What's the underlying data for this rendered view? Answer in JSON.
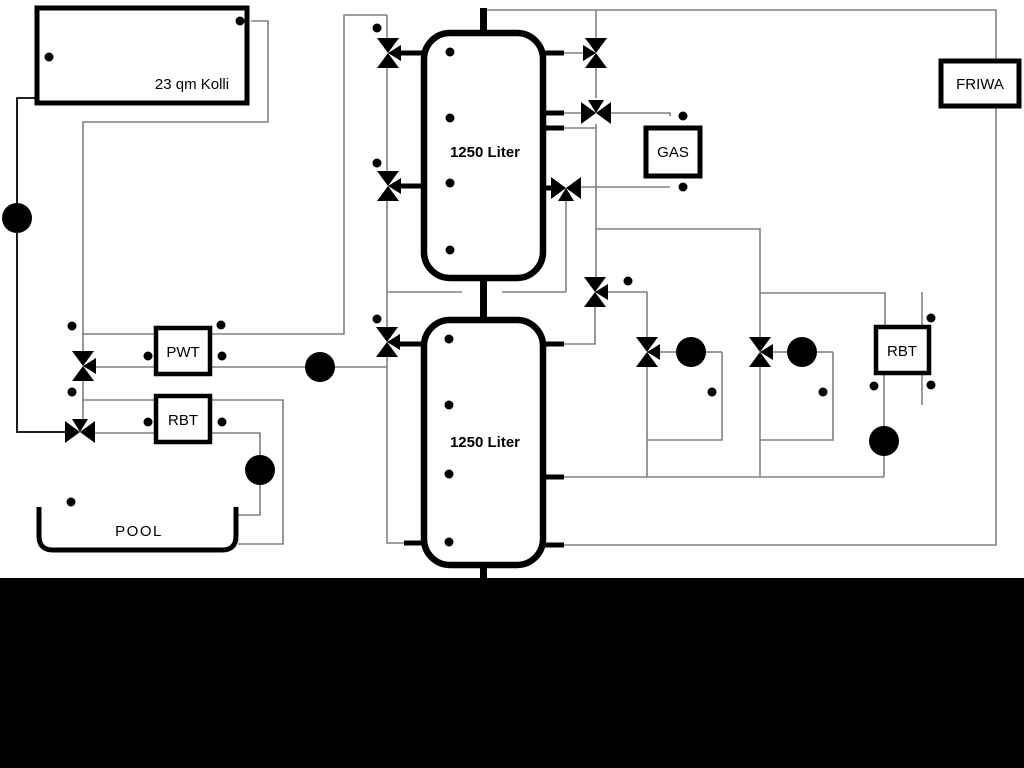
{
  "canvas": {
    "width": 1024,
    "height": 768
  },
  "colors": {
    "background": "#ffffff",
    "pipe_gray": "#808080",
    "pipe_black": "#000000",
    "bottom_band": "#000000"
  },
  "components": {
    "collector": {
      "label": "23 qm Kolli"
    },
    "upper_tank": {
      "label": "1250 Liter"
    },
    "lower_tank": {
      "label": "1250 Liter"
    },
    "gas_boiler": {
      "label": "GAS"
    },
    "friwa_station": {
      "label": "FRIWA"
    },
    "pwt_exchanger": {
      "label": "PWT"
    },
    "rbt_left": {
      "label": "RBT"
    },
    "rbt_right": {
      "label": "RBT"
    },
    "pool": {
      "label": "POOL"
    }
  },
  "icons": {
    "pump": "circle-with-filled-triangle",
    "three_way_valve": "bowtie-with-branch-triangle",
    "sensor": "small-circle-with-tail"
  }
}
